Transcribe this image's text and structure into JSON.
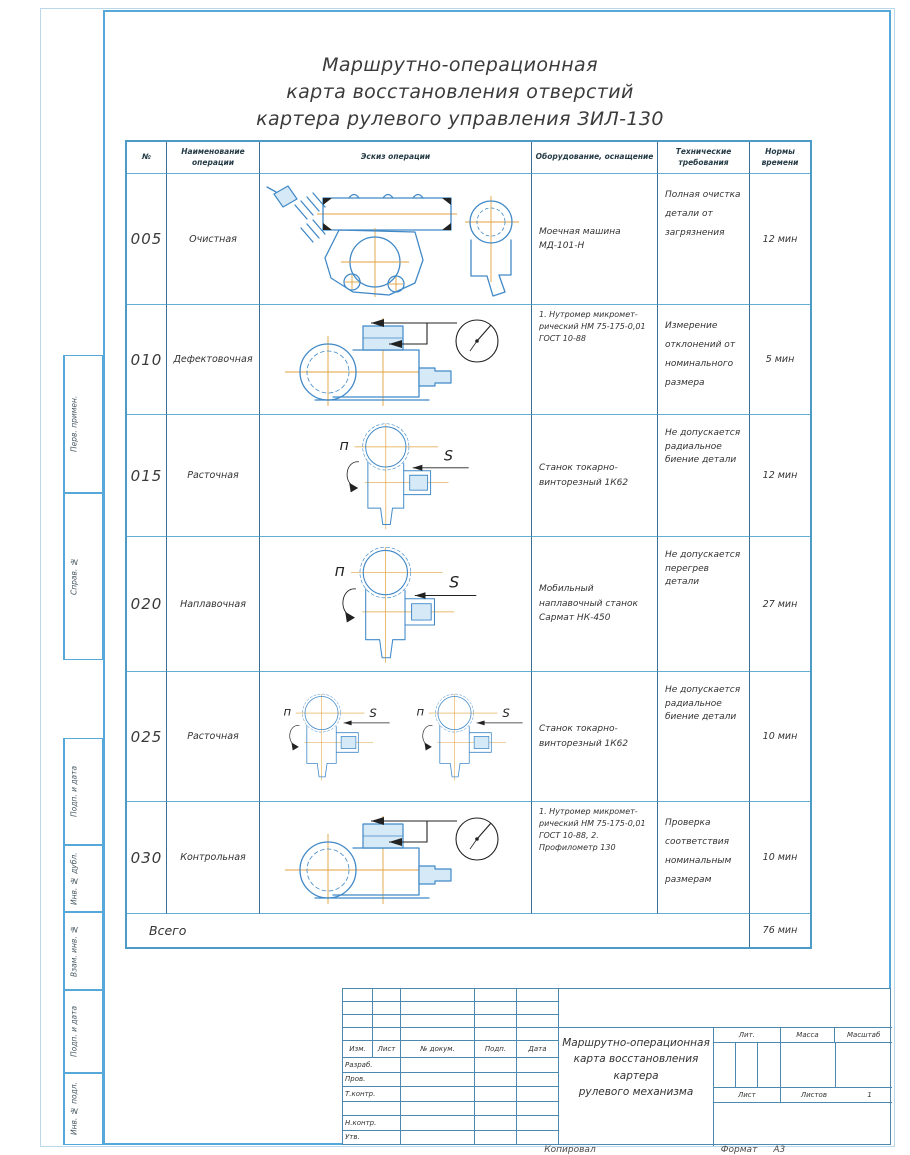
{
  "sheet": {
    "title_lines": [
      "Маршрутно-операционная",
      "карта восстановления отверстий",
      "картера рулевого управления ЗИЛ-130"
    ]
  },
  "margin_labels": [
    "Перв. примен.",
    "Справ. №",
    "Подп. и дата",
    "Инв. № дубл.",
    "Взам. инв. №",
    "Подп. и дата",
    "Инв. № подл."
  ],
  "table": {
    "headers": [
      "№",
      "Наименование операции",
      "Эскиз операции",
      "Оборудование, оснащение",
      "Технические требования",
      "Нормы времени"
    ],
    "rows": [
      {
        "num": "005",
        "name": "Очистная",
        "equipment": "Моечная машина МД-101-Н",
        "requirements": "Полная очистка детали от загрязнения",
        "time": "12 мин"
      },
      {
        "num": "010",
        "name": "Дефектовочная",
        "equipment": "1. Нутромер микромет- рический НМ 75-175-0,01 ГОСТ 10-88",
        "requirements": "Измерение отклонений от номинального размера",
        "time": "5 мин"
      },
      {
        "num": "015",
        "name": "Расточная",
        "equipment": "Станок токарно-винторезный 1К62",
        "requirements": "Не допускается радиальное биение детали",
        "time": "12 мин"
      },
      {
        "num": "020",
        "name": "Наплавочная",
        "equipment": "Мобильный наплавочный станок Сармат НК-450",
        "requirements": "Не допускается перегрев детали",
        "time": "27 мин"
      },
      {
        "num": "025",
        "name": "Расточная",
        "equipment": "Станок токарно-винторезный 1К62",
        "requirements": "Не допускается радиальное биение детали",
        "time": "10 мин"
      },
      {
        "num": "030",
        "name": "Контрольная",
        "equipment": "1. Нутромер микромет- рический НМ 75-175-0,01 ГОСТ 10-88, 2. Профилометр 130",
        "requirements": "Проверка соответствия номинальным размерам",
        "time": "10 мин"
      }
    ],
    "total_label": "Всего",
    "total_time": "76 мин"
  },
  "sketch_labels": {
    "rotation": "п",
    "feed": "S"
  },
  "title_block": {
    "change_headers": [
      "Изм.",
      "Лист",
      "№ докум.",
      "Подп.",
      "Дата"
    ],
    "signature_rows": [
      "Разраб.",
      "Пров.",
      "Т.контр.",
      "Н.контр.",
      "Утв."
    ],
    "doc_title_lines": [
      "Маршрутно-операционная",
      "карта восстановления картера",
      "рулевого механизма"
    ],
    "lit_label": "Лит.",
    "mass_label": "Масса",
    "scale_label": "Масштаб",
    "sheet_label": "Лист",
    "sheets_label": "Листов",
    "sheets_value": "1",
    "copied_label": "Копировал",
    "format_label": "Формат",
    "format_value": "А3"
  },
  "colors": {
    "frame_blue": "#56a8d8",
    "grid_vertical": "#3a6f94",
    "grid_horizontal": "#63aed3",
    "sketch_line": "#4189c7",
    "centerline_orange": "#e0a23e"
  }
}
